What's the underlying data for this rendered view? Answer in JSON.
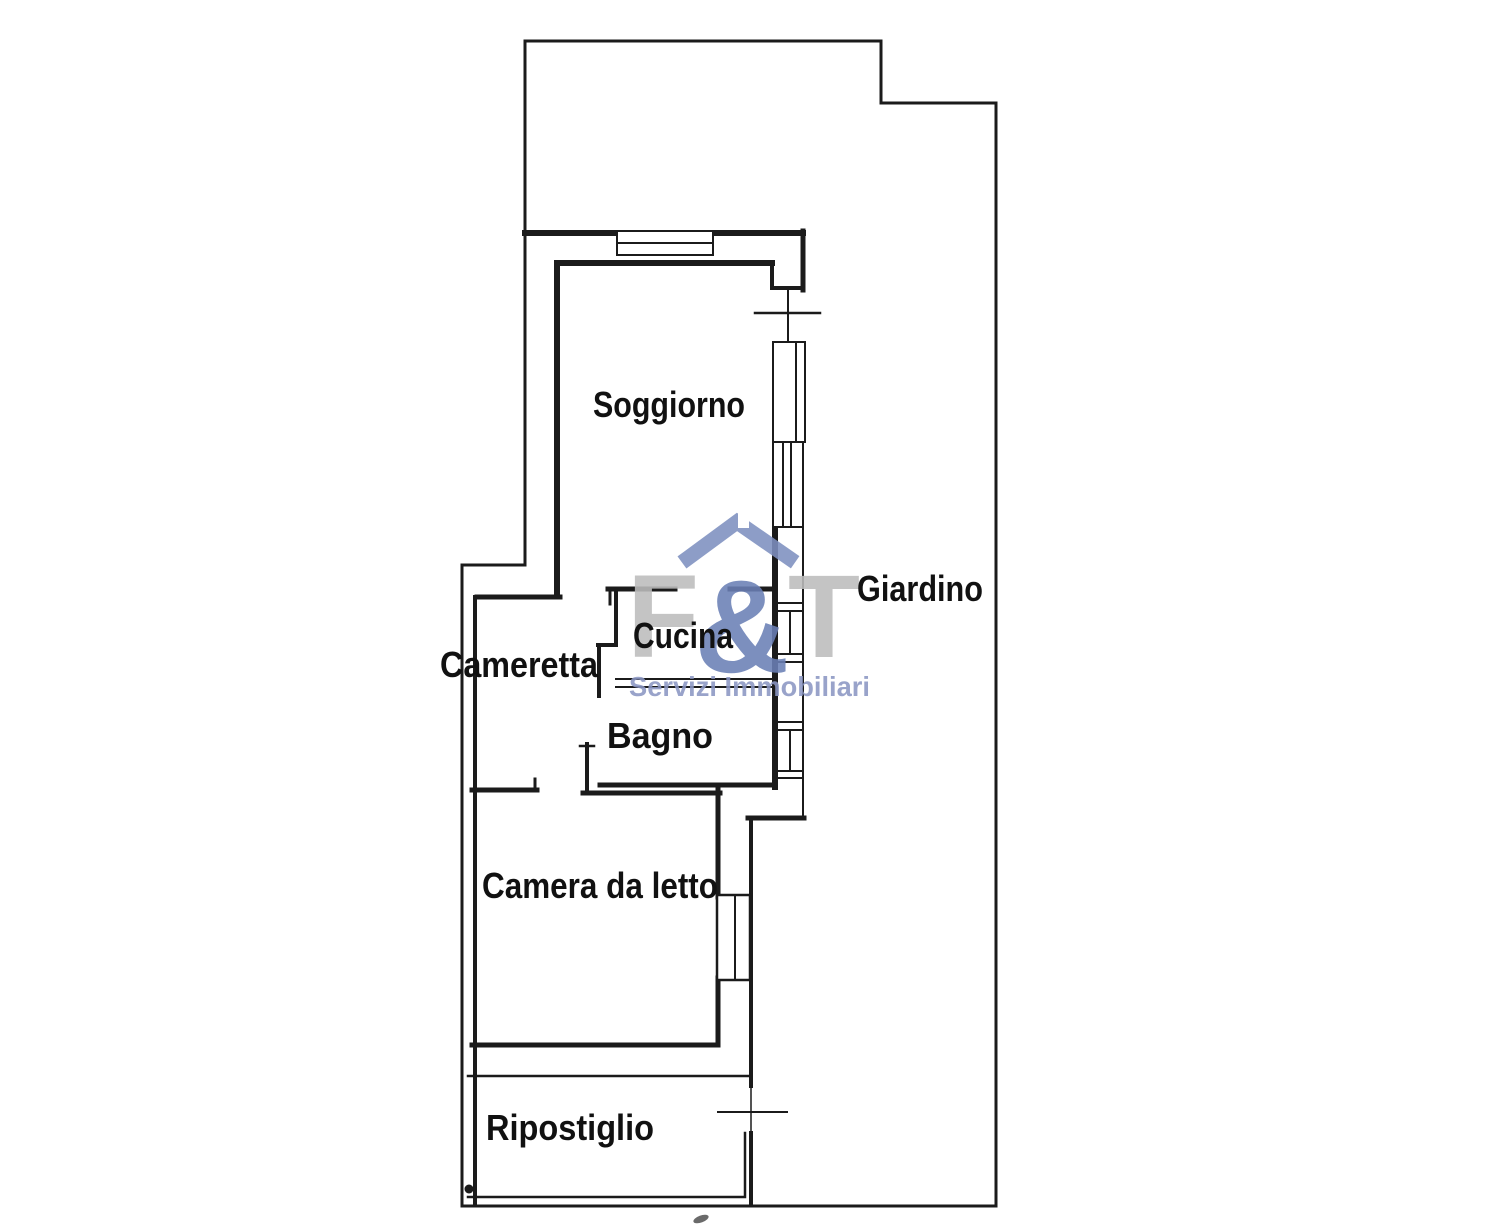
{
  "floorplan": {
    "rooms": [
      {
        "label": "Soggiorno"
      },
      {
        "label": "Giardino"
      },
      {
        "label": "Cucina"
      },
      {
        "label": "Cameretta"
      },
      {
        "label": "Bagno"
      },
      {
        "label": "Camera da letto"
      },
      {
        "label": "Ripostiglio"
      }
    ],
    "watermark": {
      "logo_f": "F",
      "logo_amp": "&",
      "logo_t": "T",
      "tagline": "Servizi Immobiliari"
    },
    "colors": {
      "wall": "#1b1b1b",
      "label": "#111111",
      "watermark_gray": "#bdbdbd",
      "watermark_blue": "#6b80b6",
      "watermark_roof": "#7e90c0",
      "tagline": "#8b97c3",
      "paper": "#ffffff"
    }
  }
}
